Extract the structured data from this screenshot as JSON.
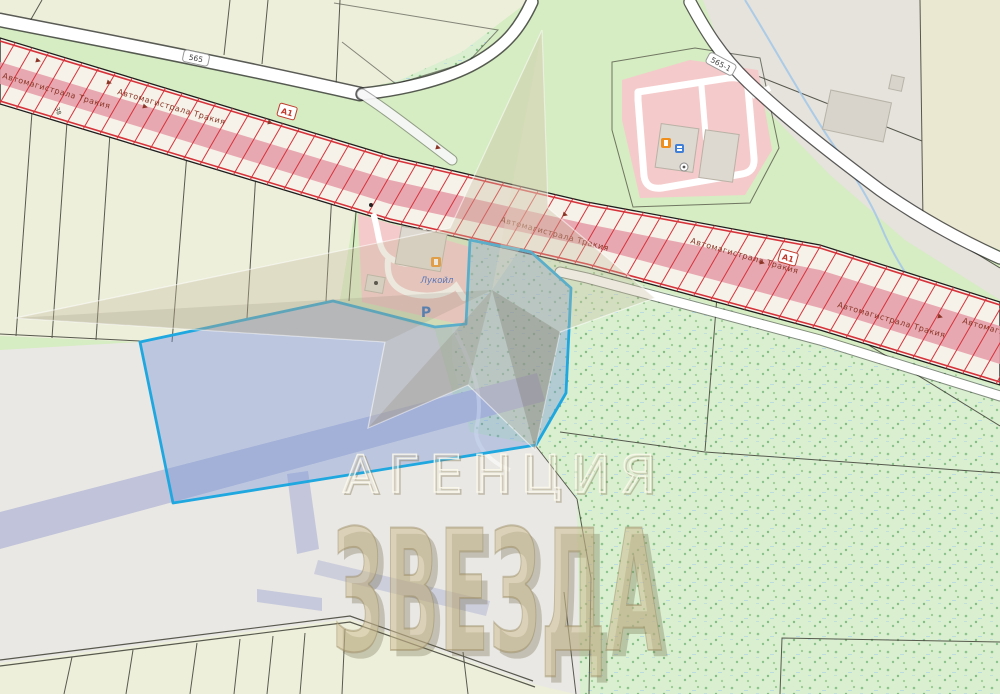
{
  "map": {
    "watermark": {
      "line1": "АГЕНЦИЯ",
      "line2": "ЗВЕЗДА",
      "symbol": "star-watermark"
    },
    "highway": {
      "name": "Автомагистрала Тракия",
      "ref": "А1"
    },
    "roads": {
      "ref_565": "565",
      "ref_565_1": "565-1"
    },
    "parcel": {
      "label": "38"
    },
    "station": {
      "brand": "Лукойл",
      "parking": "Р"
    },
    "selected_parcel": {
      "outline_color": "#1fa7e0",
      "fill_color": "rgba(115,145,215,0.38)"
    },
    "colors": {
      "highway_hatch": "#d6323a",
      "highway_stripe": "#e7a0ab",
      "farmland": "#edefdb",
      "grass": "#d6ecc2",
      "scrub": "#d9efd0",
      "urban_gray": "#e9e8e4",
      "station_pink": "#f5caca",
      "road_white": "#ffffff",
      "watermark_tan": "#c9b88e"
    },
    "icons": [
      "fuel-station-icon",
      "services-icon",
      "info-icon",
      "direction-arrow-icon",
      "star-watermark",
      "poi-dot"
    ]
  }
}
